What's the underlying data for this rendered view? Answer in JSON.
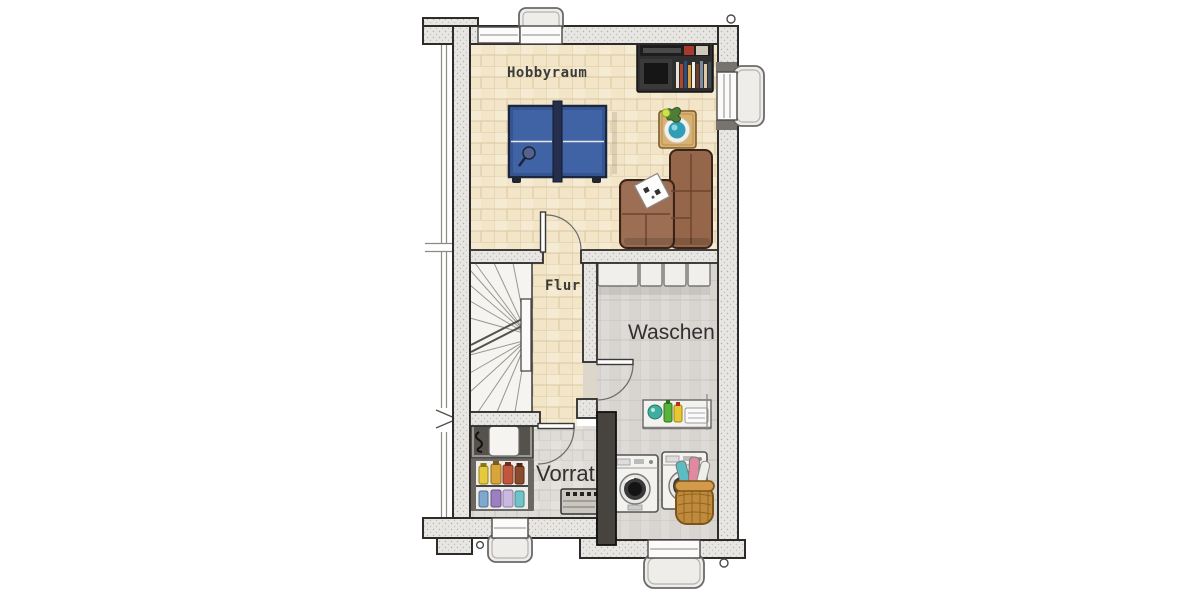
{
  "floor_plan": {
    "rooms": [
      {
        "id": "hobbyraum",
        "label": "Hobbyraum"
      },
      {
        "id": "flur",
        "label": "Flur"
      },
      {
        "id": "waschen",
        "label": "Waschen"
      },
      {
        "id": "vorrat",
        "label": "Vorrat"
      }
    ],
    "furniture": [
      "ping-pong-table",
      "media-shelf",
      "plant-side-table",
      "corner-sofa",
      "game-card",
      "winder-stairs",
      "wall-cabinets",
      "laundry-shelf",
      "washing-machine",
      "dryer",
      "laundry-basket",
      "freezer",
      "storage-shelf",
      "work-chest"
    ],
    "colors": {
      "wall_fill": "#e8e6e2",
      "wall_line": "#2e2c2a",
      "wall_dark": "#474440",
      "floor_wood": "#f3e6c8",
      "floor_tile_gray": "#d8d4d0",
      "floor_tile_light": "#dfdbd6",
      "stair_floor": "#f6f4f0",
      "table_blue": "#3f63a4",
      "sofa_brown": "#96664a",
      "basket_tan": "#c08a3e",
      "shelf_dark": "#2f2f2f",
      "label_dark": "#3b3b3b"
    }
  }
}
